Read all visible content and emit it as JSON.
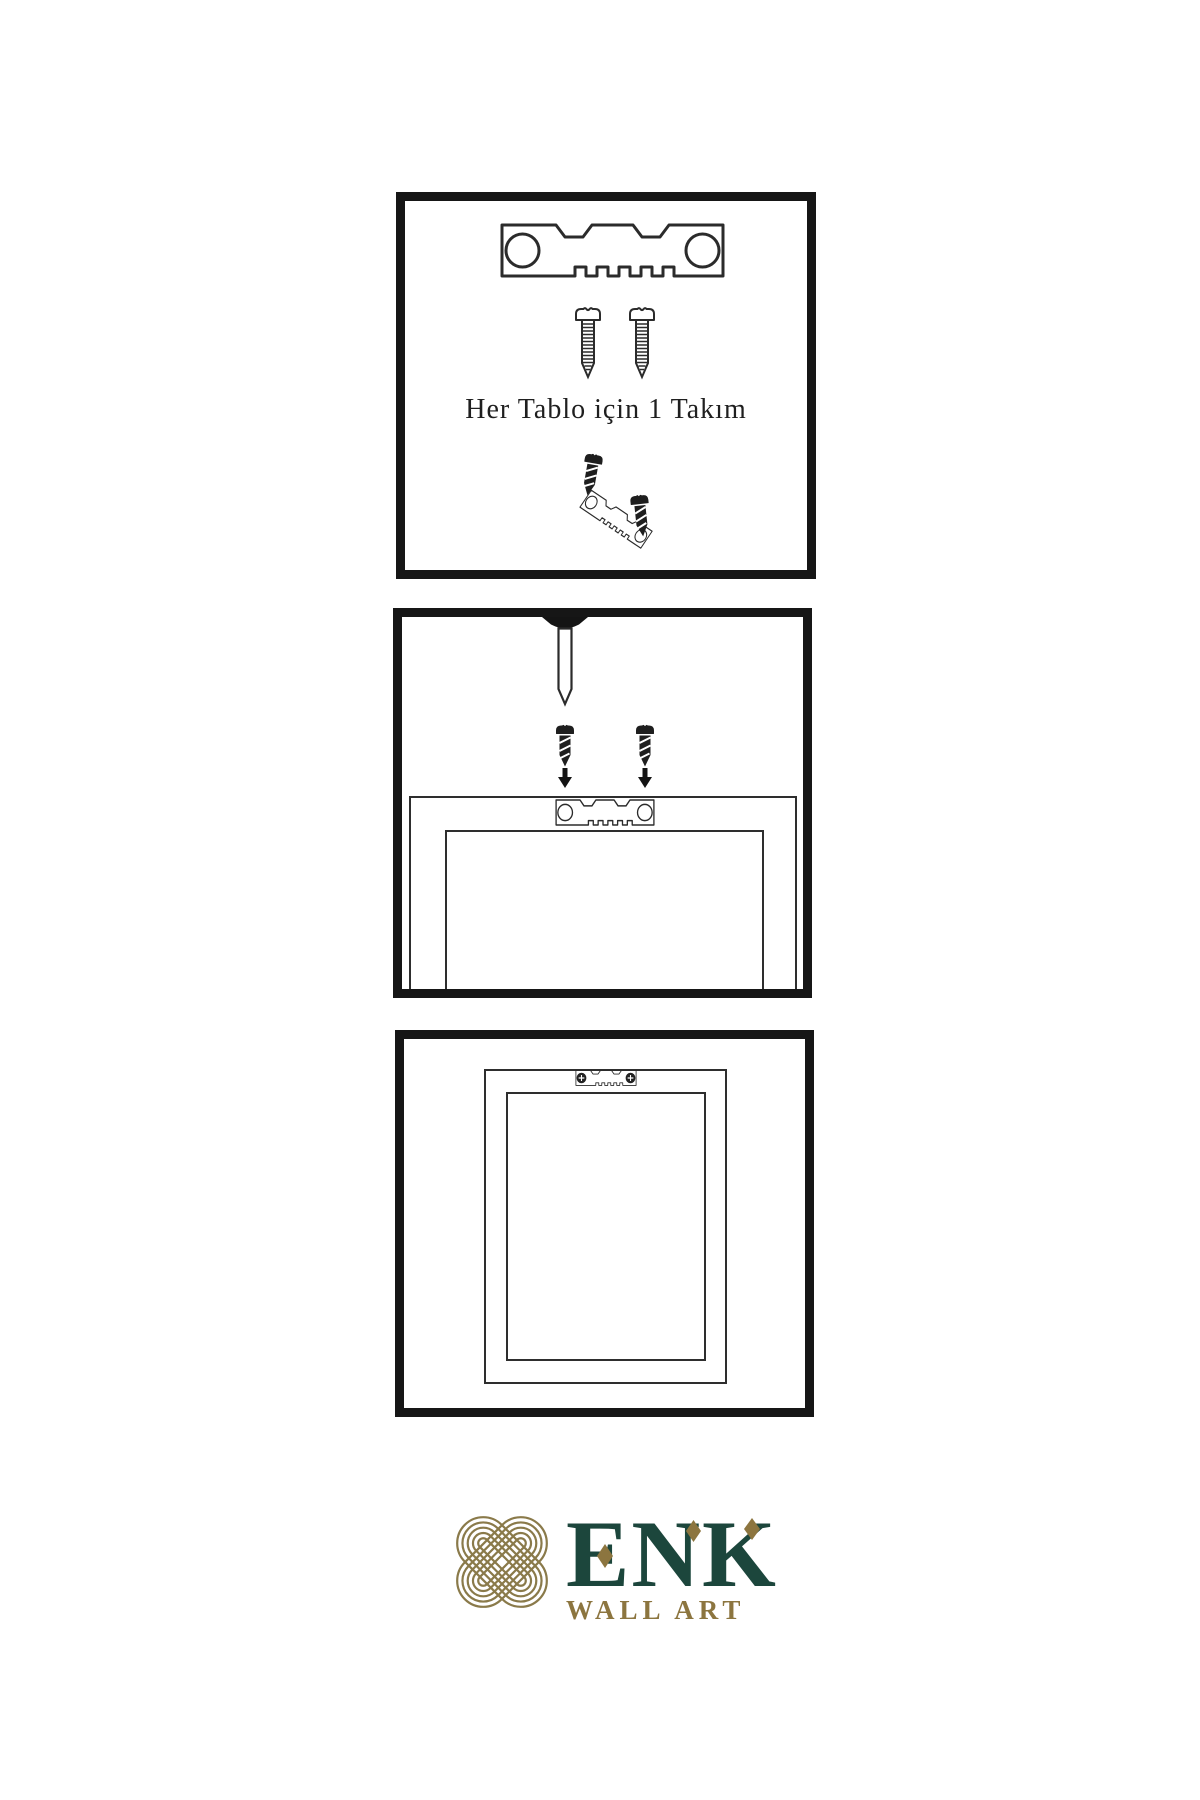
{
  "canvas": {
    "background": "#ffffff",
    "width": 1200,
    "height": 1800
  },
  "panel_hardware_kit": {
    "caption": "Her Tablo için 1 Takım",
    "icons": [
      "sawtooth-hanger-icon",
      "screw-icon",
      "screw-icon",
      "screw-dark-icon",
      "sawtooth-hanger-tilted-icon",
      "screw-dark-icon"
    ]
  },
  "panel_attach_hanger": {
    "icons": [
      "nail-icon",
      "screw-dark-icon",
      "screw-dark-icon",
      "arrow-down-icon",
      "arrow-down-icon",
      "sawtooth-hanger-icon",
      "frame-back-outline"
    ]
  },
  "panel_hang_frame": {
    "icons": [
      "sawtooth-hanger-mounted-icon",
      "frame-front-outline"
    ]
  },
  "logo": {
    "brand": "ENK",
    "subtitle": "WALL ART",
    "emblem_icon": "knot-emblem-icon",
    "brand_color": "#1c463c",
    "accent_color": "#8c753f",
    "emblem_color": "#8a7a4a"
  },
  "line_color": "#2b2b2b",
  "panel_border_color": "#161616"
}
